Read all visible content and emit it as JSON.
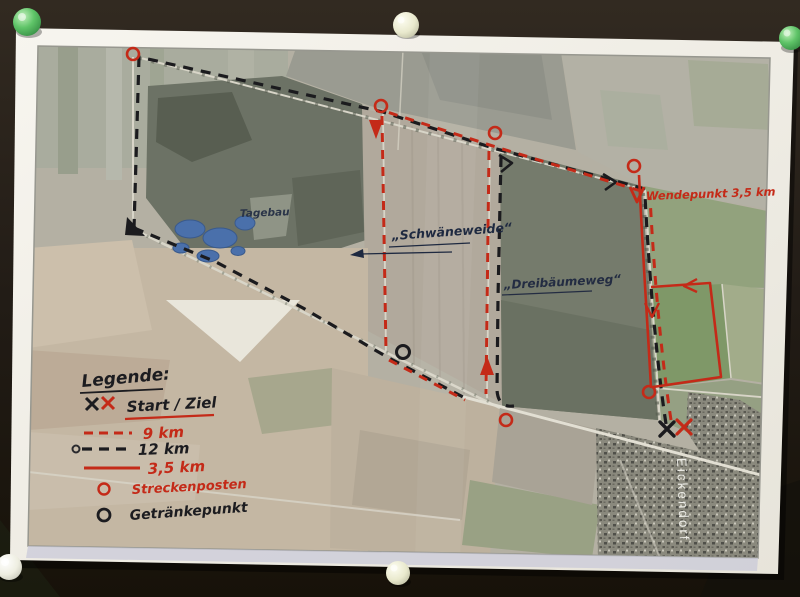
{
  "legend": {
    "title": "Legende:",
    "start_ziel": "Start / Ziel",
    "km9": "9 km",
    "km12": "12 km",
    "km35": "3,5 km",
    "streckenposten": "Streckenposten",
    "getraenkepunkt": "Getränkepunkt"
  },
  "map_labels": {
    "tagebau": "Tagebau",
    "schwaeneweide": "„Schwäneweide“",
    "dreibaeumeweg": "„Dreibäumeweg“",
    "wendepunkt": "Wendepunkt 3,5 km",
    "village": "Eickendorf"
  },
  "colors": {
    "route_red": "#c42a18",
    "route_black": "#1b1b1e",
    "ink_blue": "#24304a",
    "paper": "#f2f0e9",
    "board": "#2a231c",
    "pond_blue": "#4a70ab"
  },
  "pins": [
    {
      "position": "top-left",
      "color": "green"
    },
    {
      "position": "top-center",
      "color": "cream"
    },
    {
      "position": "top-right",
      "color": "green"
    },
    {
      "position": "bottom-center",
      "color": "cream"
    },
    {
      "position": "bottom-left",
      "color": "white"
    }
  ]
}
